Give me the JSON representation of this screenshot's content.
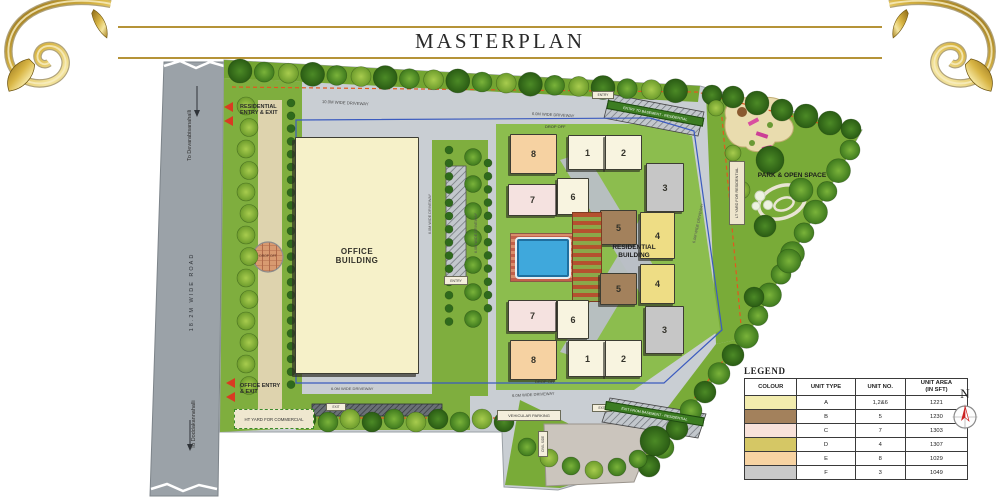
{
  "title": "MASTERPLAN",
  "compass_label": "N",
  "road": {
    "name": "18.2M  WIDE  ROAD",
    "to_top": "To Devarabisanahalli",
    "to_bottom": "To Doddakannahalli"
  },
  "entries": {
    "residential": "RESIDENTIAL ENTRY & EXIT",
    "office": "OFFICE ENTRY & EXIT"
  },
  "buildings": {
    "office": "OFFICE BUILDING",
    "residential": "RESIDENTIAL BUILDING"
  },
  "areas": {
    "park": "PARK & OPEN SPACE",
    "ht_yard": "HT YARD FOR COMMERCIAL",
    "lt_yard": "LT YARD FOR RESIDENTIAL",
    "parking": "VEHICULAR PARKING",
    "civil": "CIVIL SIDE"
  },
  "circulation": {
    "driveway_10m": "10.0M WIDE DRIVEWAY",
    "driveway_6m": "6.0M WIDE DRIVEWAY",
    "drop_off": "DROP OFF",
    "entry": "ENTRY",
    "exit": "EXIT",
    "entry_basement": "ENTRY TO BASEMENT - RESIDENTIAL",
    "exit_basement": "EXIT FROM BASEMENT - RESIDENTIAL"
  },
  "blocks": {
    "b1": "1",
    "b2": "2",
    "b3": "3",
    "b4": "4",
    "b5": "5",
    "b6": "6",
    "b7": "7",
    "b8": "8"
  },
  "block_colors": {
    "a": "#f8f4e0",
    "b": "#a3815c",
    "c": "#f5e2e0",
    "d": "#eedd85",
    "e": "#f6d2a2",
    "f": "#c6c6c6"
  },
  "office_color": "#f6f1c9",
  "colors": {
    "gold_rule": "#b59338",
    "entry_arrow": "#d93a22",
    "setback_line": "#3b5bbf",
    "boundary_dash": "#e2571f",
    "pool": "#3fa8dc"
  },
  "legend": {
    "title": "LEGEND",
    "columns": [
      "COLOUR",
      "UNIT TYPE",
      "UNIT NO.",
      "UNIT AREA\n(IN SFT)"
    ],
    "rows": [
      {
        "color": "#f2ecae",
        "type": "A",
        "no": "1,2&6",
        "area": "1221"
      },
      {
        "color": "#a3815c",
        "type": "B",
        "no": "5",
        "area": "1230"
      },
      {
        "color": "#f8e2da",
        "type": "C",
        "no": "7",
        "area": "1303"
      },
      {
        "color": "#d5c765",
        "type": "D",
        "no": "4",
        "area": "1307"
      },
      {
        "color": "#f7d3a2",
        "type": "E",
        "no": "8",
        "area": "1029"
      },
      {
        "color": "#c9c9c9",
        "type": "F",
        "no": "3",
        "area": "1049"
      }
    ]
  }
}
